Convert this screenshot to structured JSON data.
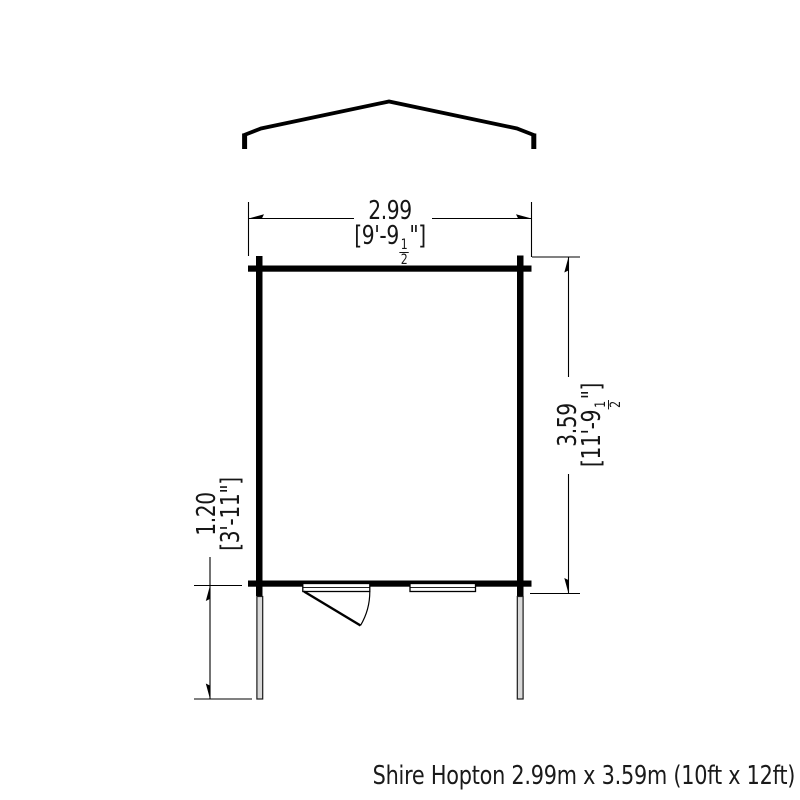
{
  "caption": "Shire Hopton 2.99m x 3.59m (10ft x 12ft)",
  "dim_width": {
    "metric": "2.99",
    "imp_prefix": "[9'-9",
    "frac_num": "1",
    "frac_den": "2",
    "imp_suffix": "\"]"
  },
  "dim_depth": {
    "metric": "3.59",
    "imp_prefix": "[11'-9",
    "frac_num": "1",
    "frac_den": "2",
    "imp_suffix": "\"]"
  },
  "dim_porch": {
    "metric": "1.20",
    "imperial": "[3'-11\"]"
  },
  "colors": {
    "line": "#000000",
    "post_fill": "#d9d9d9",
    "background": "#ffffff"
  }
}
